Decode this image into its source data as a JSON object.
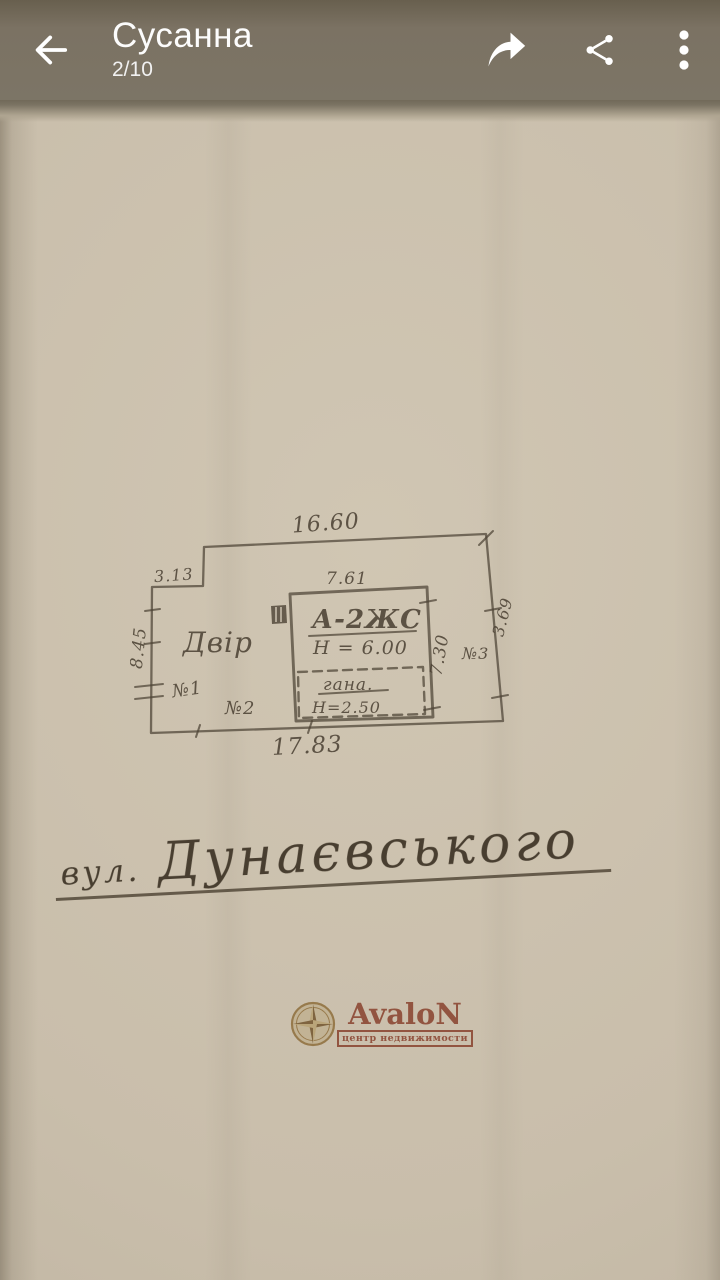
{
  "app_bar": {
    "title": "Сусанна",
    "counter": "2/10"
  },
  "plan": {
    "dim_top": "16.60",
    "dim_step": "3.13",
    "dim_building_top": "7.61",
    "dim_left": "8.45",
    "dim_bottom": "17.83",
    "dim_building_right": "7.30",
    "dim_right": "3.69",
    "label_yard": "Двір",
    "label_building": "А-2ЖС",
    "label_building_height": "Н = 6.00",
    "label_annex": "гана.",
    "label_annex_height": "Н=2.50",
    "label_mark1": "№1",
    "label_mark2": "№2",
    "label_mark3": "№3"
  },
  "caption": {
    "prefix": "вул.",
    "street": "Дунаєвського"
  },
  "watermark": {
    "brand": "AvaloN",
    "tagline": "центр недвижимости"
  },
  "colors": {
    "ink": "#4c4234",
    "paper": "#c9beab",
    "app_bar": "#7b7263",
    "watermark_red": "#a94f3a",
    "watermark_gold": "#b08d4f"
  }
}
